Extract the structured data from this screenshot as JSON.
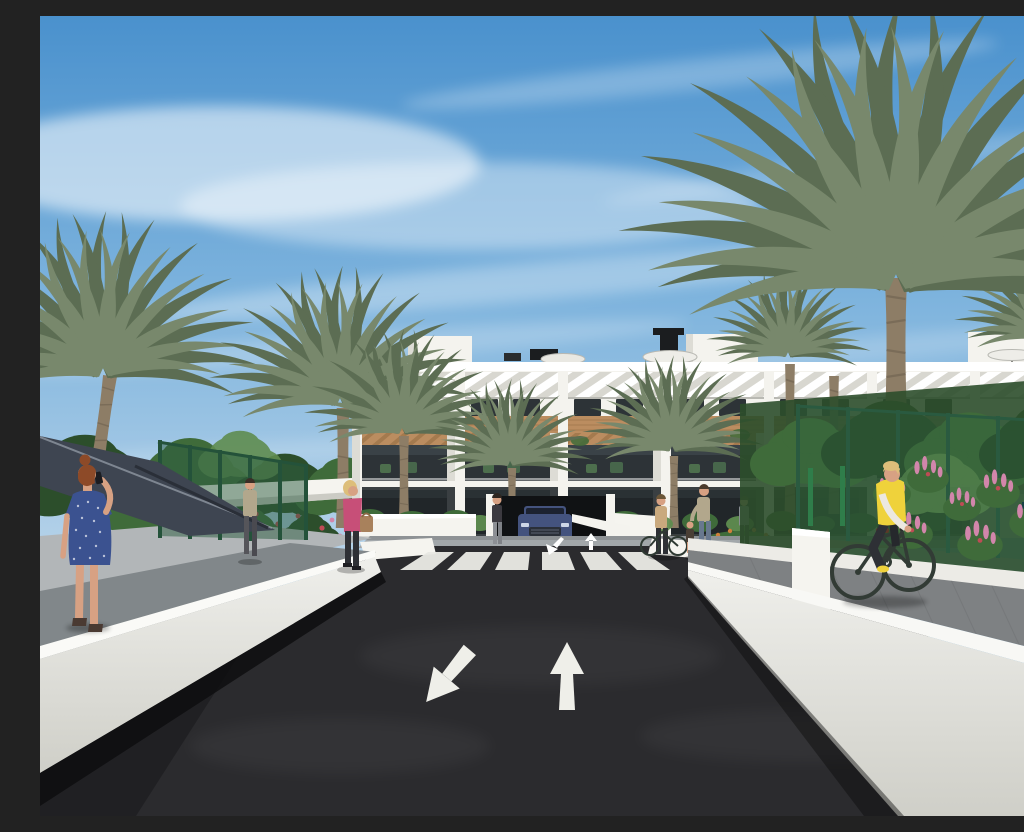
{
  "scene": {
    "type": "3d-architectural-rendering",
    "setting": "Sunny street-level rendering of a modern white apartment complex lined with palm trees: an asphalt road with a zebra crosswalk and lane arrows leads to a garage ramp with a blue SUV, while pedestrians walk the paths and a cyclist in a yellow vest rides along a white-walled bike path",
    "time_of_day": "day",
    "sky": "blue with wispy cirrus clouds",
    "objects": [
      "sky",
      "clouds",
      "apartment building with roof terraces and parasols",
      "pergola slat sun screens",
      "wood fascia bands",
      "balconies with patio furniture",
      "ground-floor glazing",
      "date palm trees",
      "garden shrubs",
      "rose bushes",
      "pink flower spikes",
      "orange flower bed",
      "green mesh fences",
      "white boundary walls",
      "asphalt road",
      "zebra crosswalk",
      "lane direction arrows",
      "garage ramp arrows",
      "blue SUV at garage ramp",
      "bicycle racks",
      "shade canopy",
      "woman in blue dotted dress talking on phone",
      "man walking on garden path",
      "woman in pink jacket with tan handbag",
      "woman standing by car ramp",
      "woman pushing bicycle",
      "adult with child",
      "person at railing",
      "residents on balcony",
      "cyclist in yellow vest"
    ]
  },
  "colors": {
    "sky_top": "#4a91cd",
    "sky_mid": "#7db3dd",
    "sky_low": "#bad5ea",
    "cloud": "#ffffff",
    "building_white": "#f4f3ee",
    "building_shade": "#dddcd5",
    "wood": "#bb8d60",
    "wood_dark": "#92693f",
    "glass": "#2d3337",
    "slat": "#d8d7d0",
    "foliage": "#3f6b3a",
    "foliage_dark": "#2c4e2b",
    "foliage_light": "#5f8c4f",
    "palm_green": "#78886c",
    "palm_dark": "#5c6d53",
    "trunk": "#8d7d66",
    "fence_green": "#2b5c40",
    "flower_pink": "#d286ab",
    "flower_red": "#bf4b55",
    "flower_orange": "#d07f3a",
    "asphalt": "#2b2b2e",
    "curb_white": "#f5f4ef",
    "wall_gray": "#d3d3ce",
    "sidewalk": "#a2a7aa",
    "sidewalk_shade": "#81878a",
    "paver": "#7e8183",
    "car_blue": "#44537e",
    "skin": "#d7a183",
    "hair_red": "#8d4a28",
    "hair_blonde": "#ddbe7a",
    "dress_blue": "#3b5290",
    "jacket_pink": "#c74f78",
    "vest_yellow": "#efd23b",
    "pants_dark": "#2e3035",
    "shirt_beige": "#b2a78c",
    "jeans": "#68788f",
    "bag_tan": "#a8815c",
    "bike_dark": "#323b35"
  }
}
